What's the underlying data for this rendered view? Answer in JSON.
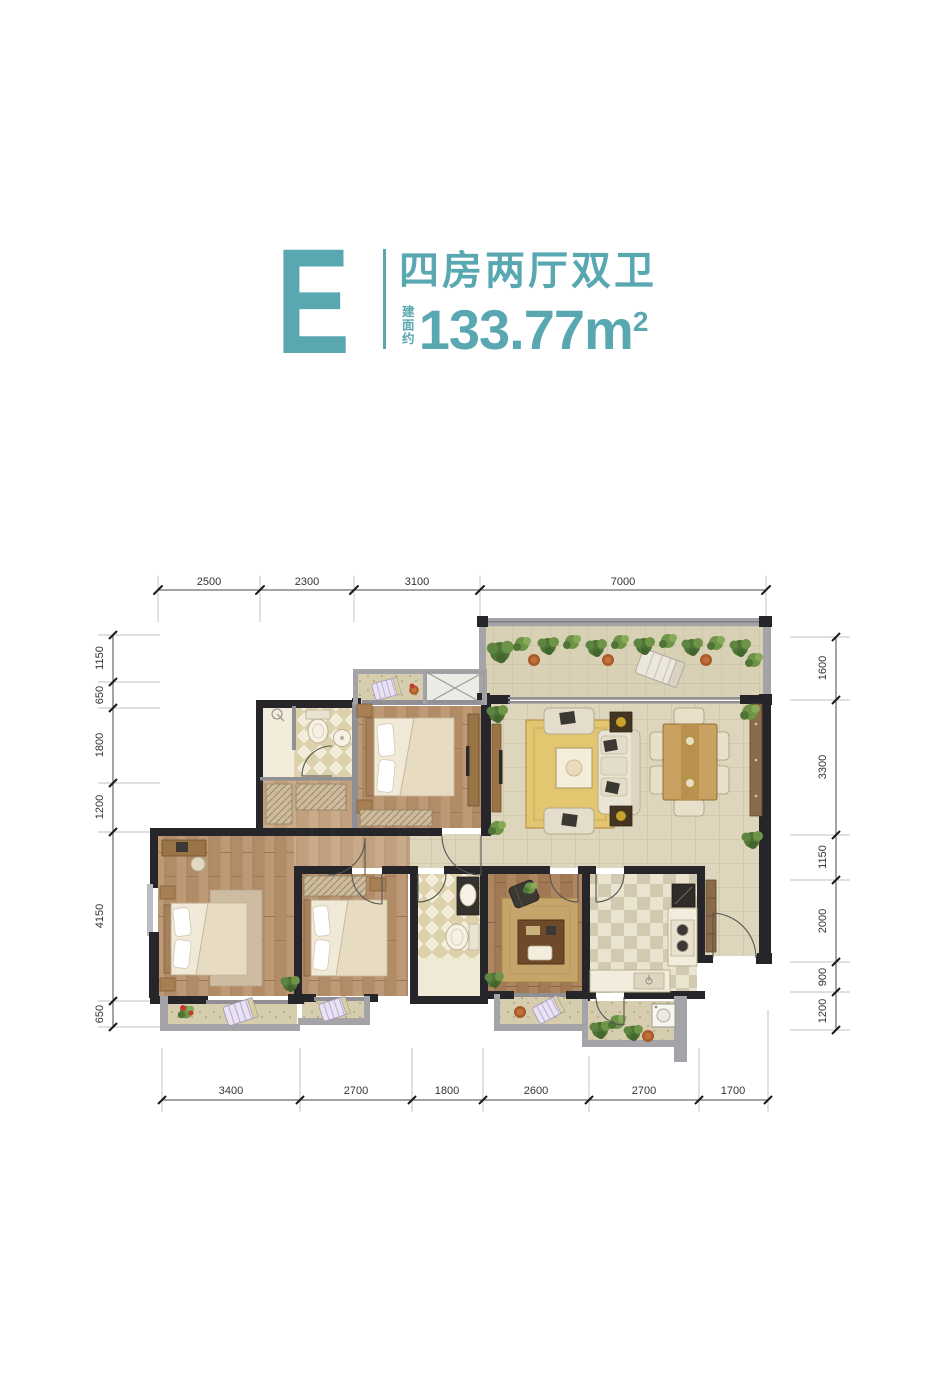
{
  "header": {
    "unit_letter": "E",
    "layout_name": "四房两厅双卫",
    "area_prefix": "建面约",
    "area_number": "133.77",
    "area_unit_base": "m",
    "area_unit_sup": "2"
  },
  "dimensions": {
    "top": [
      "2500",
      "2300",
      "3100",
      "7000"
    ],
    "bottom": [
      "3400",
      "2700",
      "1800",
      "2600",
      "2700",
      "1700"
    ],
    "left": [
      "1150",
      "650",
      "1800",
      "1200",
      "4150",
      "650"
    ],
    "right": [
      "1600",
      "3300",
      "1150",
      "2000",
      "900",
      "1200"
    ]
  },
  "colors": {
    "accent": "#58a7b1",
    "wall": "#26262a",
    "dimtext": "#333333",
    "tile": "#ded6bc",
    "wood": "#b8946f",
    "greenery": "#4e7436"
  }
}
